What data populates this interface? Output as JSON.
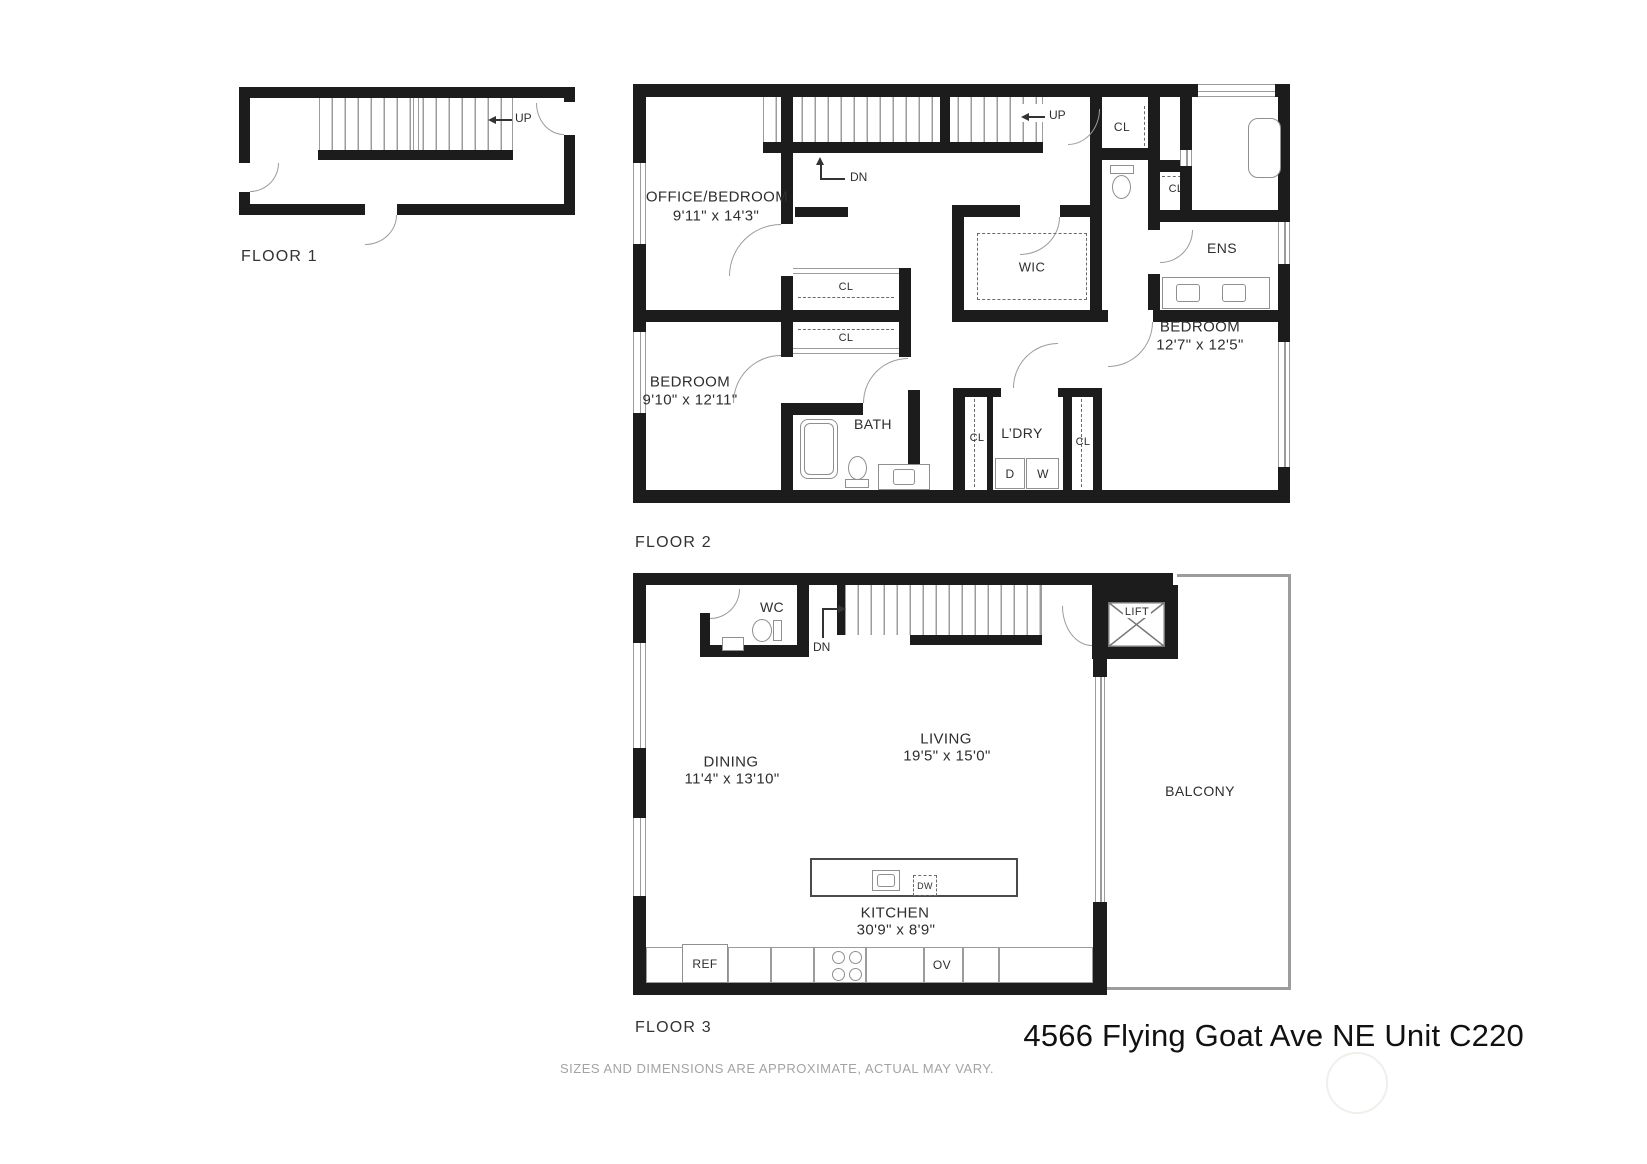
{
  "footer": {
    "address": "4566 Flying Goat Ave NE Unit C220",
    "disclaimer": "SIZES AND DIMENSIONS ARE APPROXIMATE, ACTUAL MAY VARY."
  },
  "labels": {
    "closet": "CL",
    "up": "UP",
    "down": "DN",
    "dryer": "D",
    "washer": "W",
    "fridge": "REF",
    "oven": "OV",
    "dishwasher": "DW"
  },
  "floor1": {
    "label": "FLOOR 1"
  },
  "floor2": {
    "label": "FLOOR 2",
    "office": {
      "name": "OFFICE/BEDROOM",
      "dims": "9'11\" x 14'3\""
    },
    "bedroom1": {
      "name": "BEDROOM",
      "dims": "9'10\" x 12'11\""
    },
    "bedroom2": {
      "name": "BEDROOM",
      "dims": "12'7\" x 12'5\""
    },
    "bath": "BATH",
    "laundry": "L’DRY",
    "wic": "WIC",
    "ensuite": "ENS"
  },
  "floor3": {
    "label": "FLOOR 3",
    "wc": "WC",
    "lift": "LIFT",
    "dining": {
      "name": "DINING",
      "dims": "11'4\" x 13'10\""
    },
    "living": {
      "name": "LIVING",
      "dims": "19'5\" x 15'0\""
    },
    "kitchen": {
      "name": "KITCHEN",
      "dims": "30'9\" x 8'9\""
    },
    "balcony": "BALCONY"
  }
}
